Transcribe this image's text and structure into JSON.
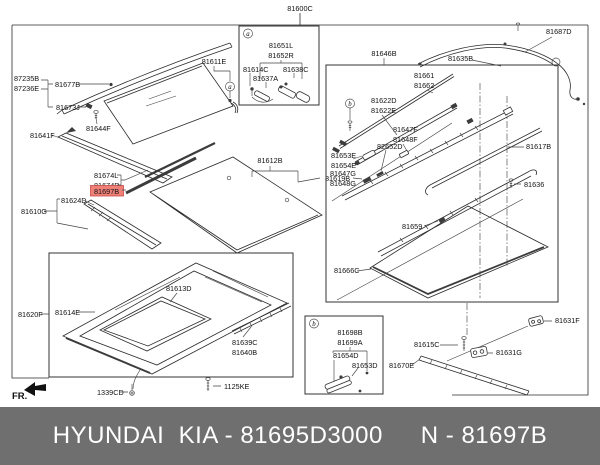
{
  "labels": {
    "l81600C": "81600C",
    "l87235B": "87235B",
    "l87236E": "87236E",
    "l81677B": "81677B",
    "l81673J": "81673J",
    "l81641F": "81641F",
    "l81644F": "81644F",
    "l81611E": "81611E",
    "l81674L": "81674L",
    "l81674R": "81674R",
    "l81697B": "81697B",
    "l81624D": "81624D",
    "l81610G": "81610G",
    "l81612B": "81612B",
    "l81619B": "81619B",
    "l81651L": "81651L",
    "l81652R": "81652R",
    "l81614C": "81614C",
    "l81637A": "81637A",
    "l81638C": "81638C",
    "l81646B": "81646B",
    "l81687D": "81687D",
    "l81635B": "81635B",
    "l81661": "81661",
    "l81662": "81662",
    "l81622D": "81622D",
    "l81622E": "81622E",
    "l81647F": "81647F",
    "l81648F": "81648F",
    "l82652D": "82652D",
    "l81653E": "81653E",
    "l81654E": "81654E",
    "l81647G": "81647G",
    "l81648G": "81648G",
    "l81617B": "81617B",
    "l81636": "81636",
    "l81659": "81659",
    "l81666C": "81666C",
    "l81615C": "81615C",
    "l81670E": "81670E",
    "l81631F": "81631F",
    "l81631G": "81631G",
    "l81698B": "81698B",
    "l81699A": "81699A",
    "l81654D": "81654D",
    "l81653D": "81653D",
    "l81620F": "81620F",
    "l81614E": "81614E",
    "l81613D": "81613D",
    "l81639C": "81639C",
    "l81640B": "81640B",
    "l1339CD": "1339CD",
    "l1125KE": "1125KE"
  },
  "markers": {
    "a": "a",
    "b": "b"
  },
  "fr_label": "FR.",
  "highlight": {
    "part": "81697B"
  },
  "colors": {
    "highlight_bg": "#ef8078",
    "highlight_border": "#cc4a44",
    "footer_bg": "#6f6f6f",
    "footer_text": "#ffffff",
    "diagram_line": "#2b2b2b",
    "label_text": "#111111"
  },
  "footer": {
    "left": "HYUNDAI  KIA - 81695D3000",
    "right": "N - 81697B"
  }
}
